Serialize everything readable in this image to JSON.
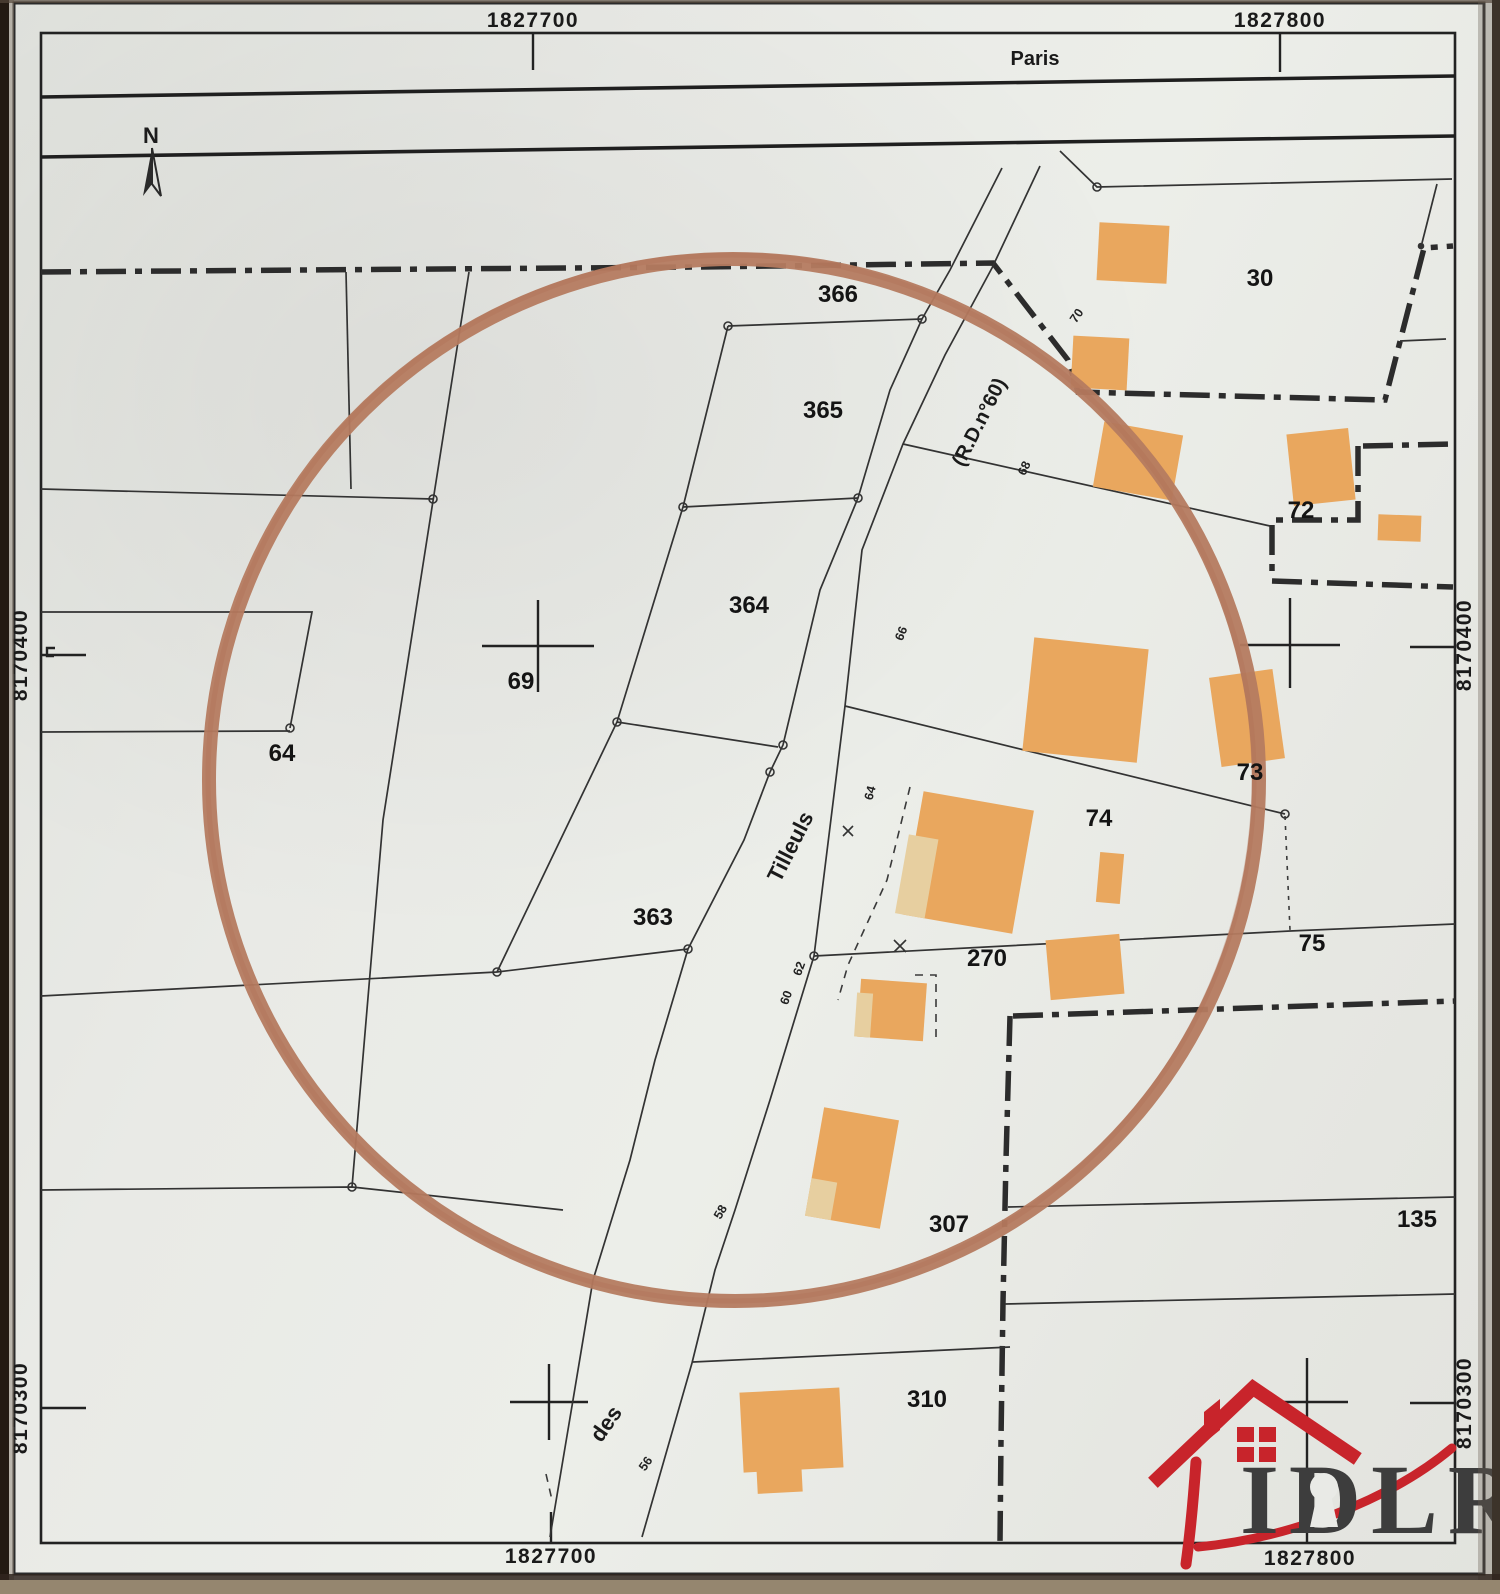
{
  "document": {
    "kind": "cadastral-plan-photo",
    "circle_annotation_color": "#b57b60",
    "building_color": "#e9a75e",
    "logo_accent_color": "#c8242b"
  },
  "north": {
    "label": "N"
  },
  "logo": {
    "wordmark": "IDLR"
  },
  "labels": {
    "coordinates": [
      {
        "id": "grid-x-1827700-top",
        "text": "1827700",
        "x": 533,
        "y": 27,
        "rot": 0
      },
      {
        "id": "grid-x-1827800-top",
        "text": "1827800",
        "x": 1280,
        "y": 27,
        "rot": 0
      },
      {
        "id": "grid-x-1827700-bottom",
        "text": "1827700",
        "x": 551,
        "y": 1563,
        "rot": 0
      },
      {
        "id": "grid-x-1827800-bottom",
        "text": "1827800",
        "x": 1310,
        "y": 1565,
        "rot": 0
      },
      {
        "id": "grid-y-8170400-left",
        "text": "8170400",
        "x": 27,
        "y": 655,
        "rot": -90
      },
      {
        "id": "grid-y-8170300-left",
        "text": "8170300",
        "x": 27,
        "y": 1408,
        "rot": -90
      },
      {
        "id": "grid-y-8170400-right",
        "text": "8170400",
        "x": 1471,
        "y": 645,
        "rot": -90
      },
      {
        "id": "grid-y-8170300-right",
        "text": "8170300",
        "x": 1471,
        "y": 1403,
        "rot": -90
      }
    ],
    "parcels": [
      {
        "id": "parcel-366",
        "text": "366",
        "x": 838,
        "y": 302
      },
      {
        "id": "parcel-365",
        "text": "365",
        "x": 823,
        "y": 418
      },
      {
        "id": "parcel-364",
        "text": "364",
        "x": 749,
        "y": 613
      },
      {
        "id": "parcel-69",
        "text": "69",
        "x": 521,
        "y": 689
      },
      {
        "id": "parcel-64",
        "text": "64",
        "x": 282,
        "y": 761
      },
      {
        "id": "parcel-363",
        "text": "363",
        "x": 653,
        "y": 925
      },
      {
        "id": "parcel-30",
        "text": "30",
        "x": 1260,
        "y": 286
      },
      {
        "id": "parcel-72",
        "text": "72",
        "x": 1301,
        "y": 518
      },
      {
        "id": "parcel-73",
        "text": "73",
        "x": 1250,
        "y": 780
      },
      {
        "id": "parcel-74",
        "text": "74",
        "x": 1099,
        "y": 826
      },
      {
        "id": "parcel-270",
        "text": "270",
        "x": 987,
        "y": 966
      },
      {
        "id": "parcel-75",
        "text": "75",
        "x": 1312,
        "y": 951
      },
      {
        "id": "parcel-307",
        "text": "307",
        "x": 949,
        "y": 1232
      },
      {
        "id": "parcel-310",
        "text": "310",
        "x": 927,
        "y": 1407
      },
      {
        "id": "parcel-135",
        "text": "135",
        "x": 1417,
        "y": 1227
      }
    ],
    "streets": [
      {
        "id": "road-paris",
        "text": "Paris",
        "x": 1035,
        "y": 65,
        "rot": 0,
        "size": 20
      },
      {
        "id": "road-rd60",
        "text": "(R.D.n°60)",
        "x": 985,
        "y": 425,
        "rot": -63,
        "size": 20
      },
      {
        "id": "street-tilleuls",
        "text": "Tilleuls",
        "x": 797,
        "y": 850,
        "rot": -63,
        "size": 22
      },
      {
        "id": "street-des",
        "text": "des",
        "x": 612,
        "y": 1428,
        "rot": -55,
        "size": 22
      }
    ],
    "road_numbers": [
      {
        "id": "addr-70",
        "text": "70",
        "x": 1080,
        "y": 318,
        "rot": -55
      },
      {
        "id": "addr-68",
        "text": "68",
        "x": 1028,
        "y": 470,
        "rot": -65
      },
      {
        "id": "addr-66",
        "text": "66",
        "x": 905,
        "y": 635,
        "rot": -68
      },
      {
        "id": "addr-64",
        "text": "64",
        "x": 874,
        "y": 794,
        "rot": -75
      },
      {
        "id": "addr-62",
        "text": "62",
        "x": 803,
        "y": 970,
        "rot": -70
      },
      {
        "id": "addr-60",
        "text": "60",
        "x": 790,
        "y": 999,
        "rot": -70
      },
      {
        "id": "addr-58",
        "text": "58",
        "x": 724,
        "y": 1214,
        "rot": -60
      },
      {
        "id": "addr-56",
        "text": "56",
        "x": 649,
        "y": 1466,
        "rot": -55
      }
    ]
  }
}
